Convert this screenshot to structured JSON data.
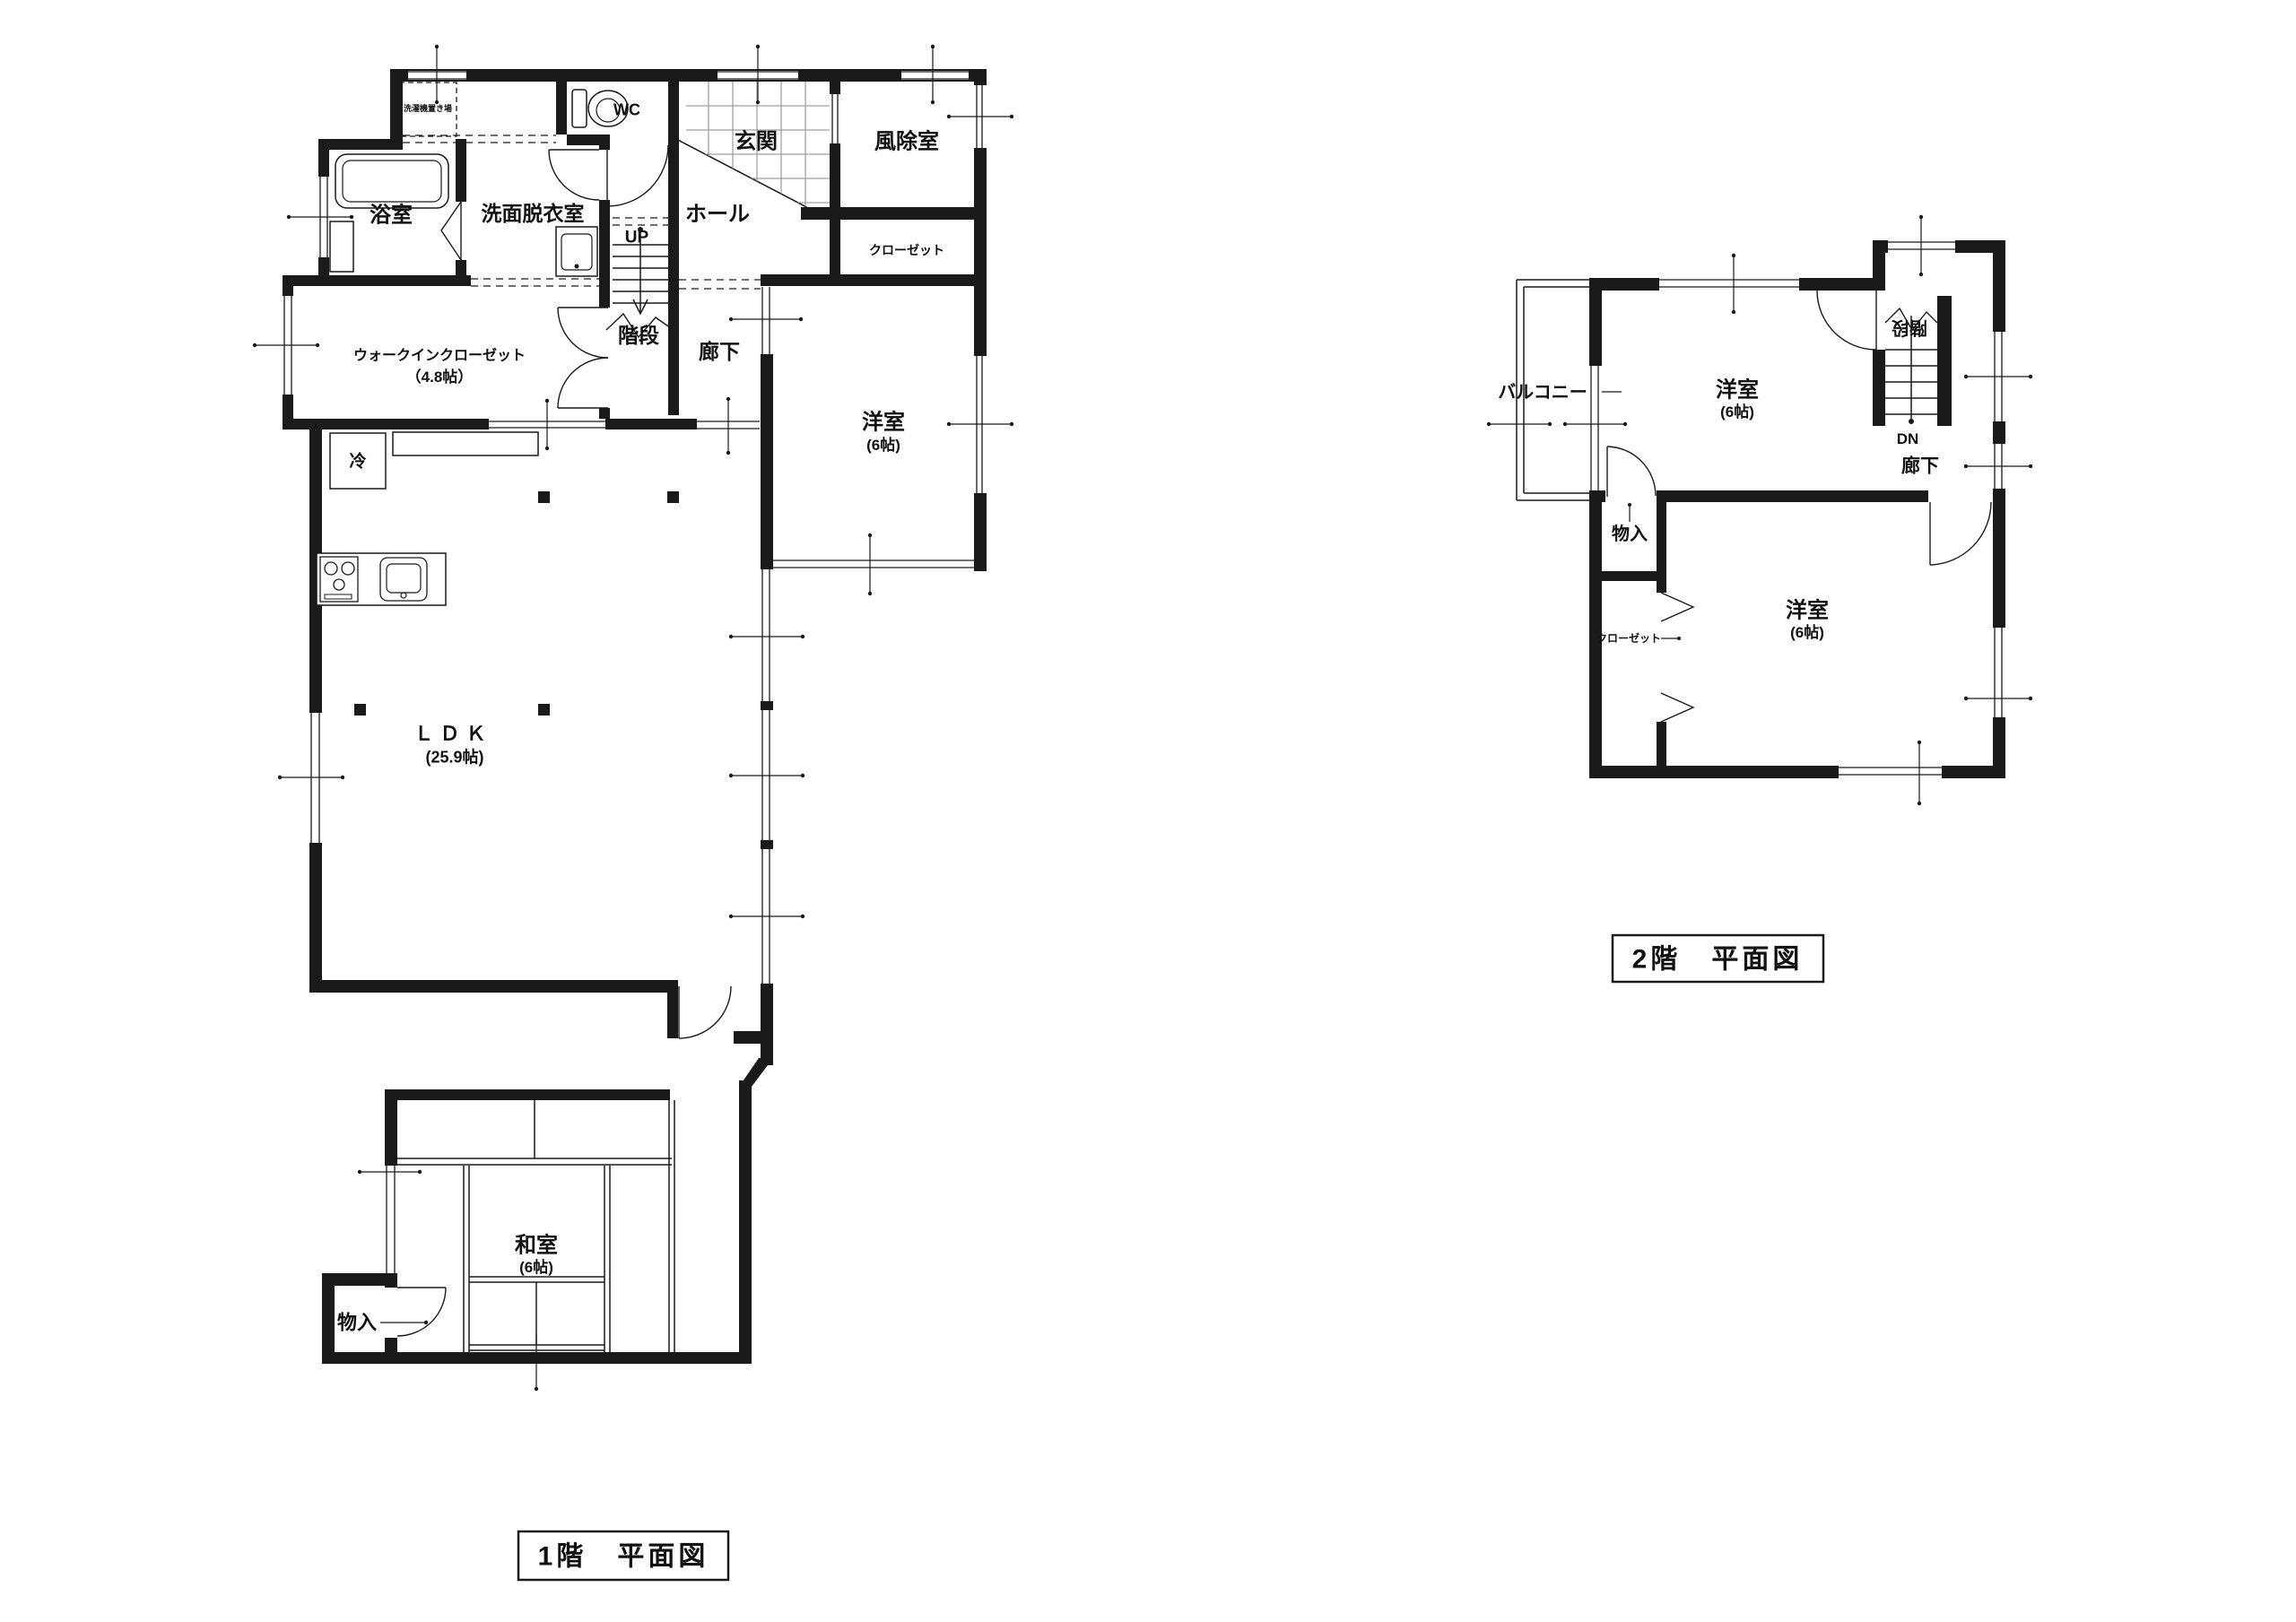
{
  "document": {
    "type": "floor-plan-drawing",
    "background": "#ffffff"
  },
  "colors": {
    "wall": "#1a1a1a",
    "thin_line": "#1a1a1a",
    "tile_grid": "#8a8a8a",
    "text": "#111111"
  },
  "floor1": {
    "title": "1階　平面図",
    "labels": {
      "laundry": "洗濯機置き場",
      "bath": "浴室",
      "washroom": "洗面脱衣室",
      "wc": "WC",
      "entrance": "玄関",
      "windbreak": "風除室",
      "hall": "ホール",
      "up": "UP",
      "closet": "クローゼット",
      "stairs": "階段",
      "corridor": "廊下",
      "wic_name": "ウォークインクローゼット",
      "wic_size": "（4.8帖）",
      "fridge": "冷",
      "ldk_name": "ＬＤＫ",
      "ldk_size": "(25.9帖)",
      "western_name": "洋室",
      "western_size": "(6帖)",
      "japanese_name": "和室",
      "japanese_size": "(6帖)",
      "storage": "物入"
    }
  },
  "floor2": {
    "title": "2階　平面図",
    "labels": {
      "balcony": "バルコニー",
      "bedroom1_name": "洋室",
      "bedroom1_size": "(6帖)",
      "bedroom2_name": "洋室",
      "bedroom2_size": "(6帖)",
      "storage": "物入",
      "closet": "クローゼット",
      "stairs": "階段",
      "dn": "DN",
      "corridor": "廊下"
    }
  }
}
